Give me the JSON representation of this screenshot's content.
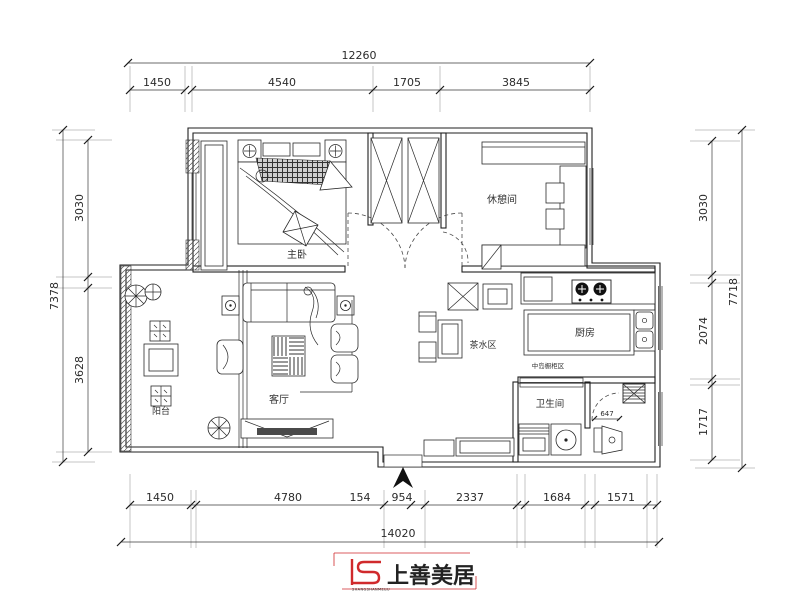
{
  "drawing": {
    "type": "apartment floor plan",
    "line_color": "#222222",
    "background": "#ffffff"
  },
  "rooms": {
    "master_bedroom": "主卧",
    "lounge": "休憩间",
    "tea_area": "茶水区",
    "kitchen": "厨房",
    "kitchen_note": "中岛橱柜区",
    "bathroom": "卫生间",
    "living_room": "客厅",
    "balcony": "阳台"
  },
  "dims": {
    "top": {
      "total": "12260",
      "segments": [
        "1450",
        "4540",
        "1705",
        "3845"
      ]
    },
    "bottom": {
      "total": "14020",
      "segments": [
        "1450",
        "4780",
        "154",
        "954",
        "2337",
        "1684",
        "1571"
      ]
    },
    "left": {
      "total": "7378",
      "segments": [
        "3030",
        "3628"
      ]
    },
    "right": {
      "total": "7718",
      "segments": [
        "3030",
        "2074",
        "1717"
      ]
    },
    "detail_toilet": "647"
  },
  "logo": {
    "brand": "上善美居",
    "caption": "SHANGSHANMEIJU",
    "color": "#d02a2c"
  }
}
